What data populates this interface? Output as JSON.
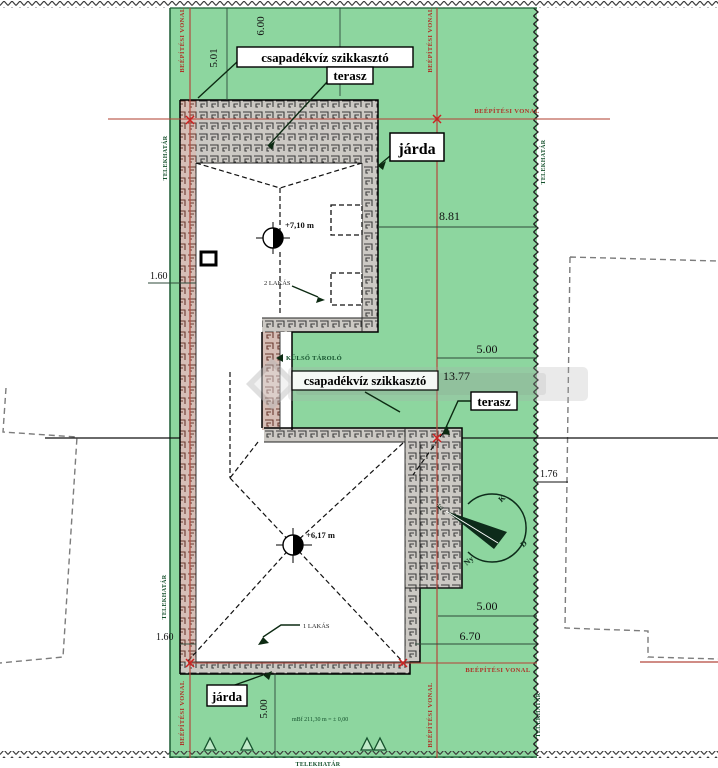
{
  "plan": {
    "labels": {
      "soakaway": "csapadékvíz szikkasztó",
      "terrace": "terasz",
      "sidewalk": "járda",
      "external_storage": "KÜLSŐ TÁROLÓ",
      "apartments_2": "2 LAKÁS",
      "apartment_1": "1 LAKÁS",
      "ridge_upper": "+7,10 m",
      "ridge_lower": "+6,17 m",
      "level_note": "mBf 211,30 m = ± 0,00"
    },
    "boundary": {
      "building_line": "BEÉPÍTÉSI VONAL",
      "plot_line": "TELEKHATÁR"
    },
    "dimensions": {
      "top_1": "5.01",
      "top_2": "6.00",
      "right_1": "8.81",
      "right_2": "5.00",
      "right_3": "13.77",
      "right_4": "1.76",
      "right_5": "5.00",
      "right_6": "6.70",
      "left_1": "1.60",
      "left_2": "1.60",
      "bottom_1": "5.00"
    },
    "compass": {
      "n": "É",
      "e": "K",
      "s": "D",
      "w": "Ny"
    },
    "colors": {
      "plot_green": "#8dd69f",
      "building_line_red": "#b5483c",
      "hatch_grey": "#ccc9c4"
    }
  }
}
